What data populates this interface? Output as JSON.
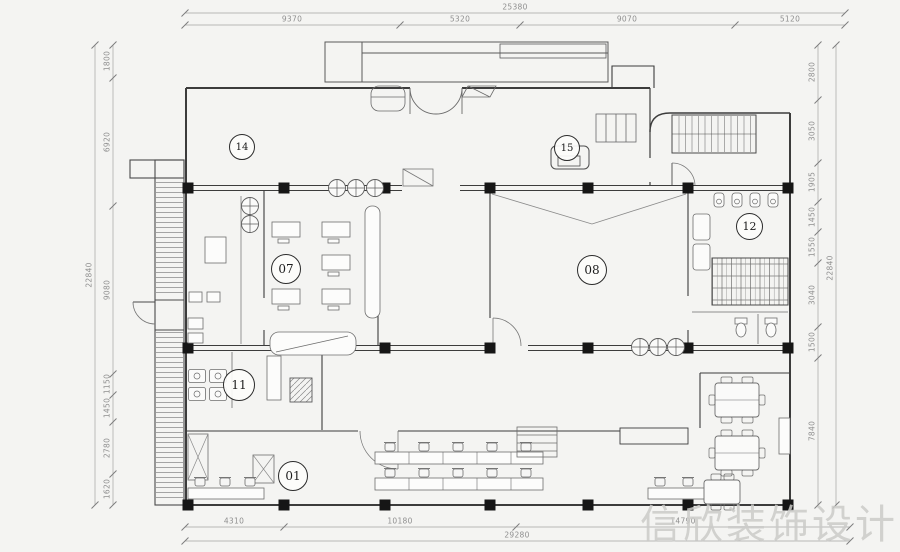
{
  "watermark": "信欣装饰设计",
  "rooms": [
    {
      "label": "14"
    },
    {
      "label": "15"
    },
    {
      "label": "07"
    },
    {
      "label": "08"
    },
    {
      "label": "12"
    },
    {
      "label": "11"
    },
    {
      "label": "01"
    }
  ],
  "dimensions": {
    "top": {
      "total": "25380",
      "segments": [
        "9370",
        "5320",
        "9070",
        "5120"
      ]
    },
    "bottom": {
      "total": "29280",
      "segments": [
        "4310",
        "10180",
        "14790"
      ]
    },
    "left": {
      "total": "22840",
      "segments": [
        "1800",
        "6920",
        "9080",
        "1150",
        "1450",
        "2780",
        "1620"
      ]
    },
    "right": {
      "total": "22840",
      "segments": [
        "2800",
        "3050",
        "1905",
        "1450",
        "1550",
        "3040",
        "1500",
        "7840"
      ]
    }
  }
}
